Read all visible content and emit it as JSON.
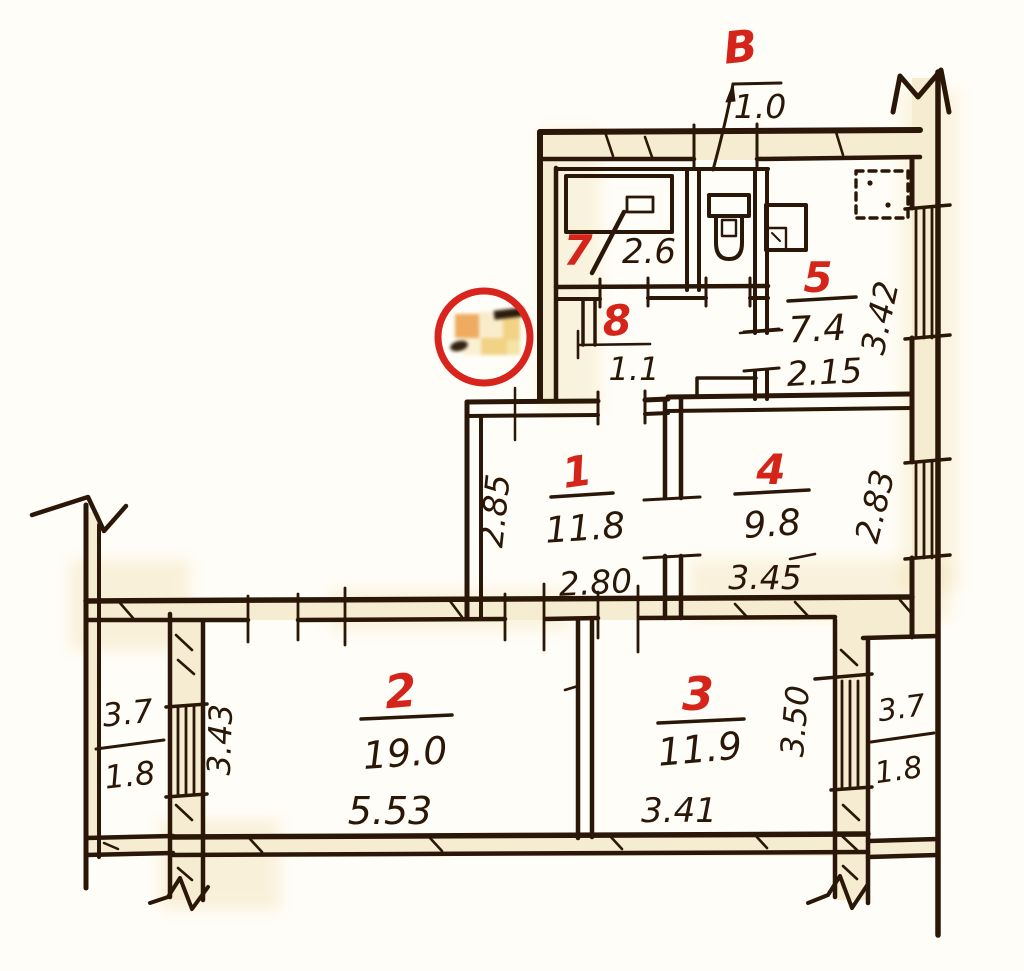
{
  "palette": {
    "ink": "#2a1708",
    "red": "#d5251a",
    "paper": "#fffdf7",
    "wall_fill": "#f6ecd2",
    "stamp_red": "#d8241c"
  },
  "entrance": {
    "label": "В",
    "door_width": "1.0"
  },
  "rooms": {
    "bath": {
      "number": "7",
      "area": "2.6"
    },
    "wc_hall": {
      "number": "8",
      "area": "1.1"
    },
    "kitchen": {
      "number": "5",
      "area": "7.4",
      "width": "2.15",
      "depth": "3.42"
    },
    "hall": {
      "number": "1",
      "area": "11.8",
      "width": "2.80",
      "depth": "2.85"
    },
    "room4": {
      "number": "4",
      "area": "9.8",
      "width": "3.45",
      "depth": "2.83"
    },
    "room2": {
      "number": "2",
      "area": "19.0",
      "width": "5.53"
    },
    "room3": {
      "number": "3",
      "area": "11.9",
      "width": "3.41"
    },
    "balcony_left": {
      "width": "3.7",
      "area": "1.8",
      "length": "3.43"
    },
    "balcony_right": {
      "width": "3.7",
      "area": "1.8",
      "length": "3.50"
    }
  }
}
